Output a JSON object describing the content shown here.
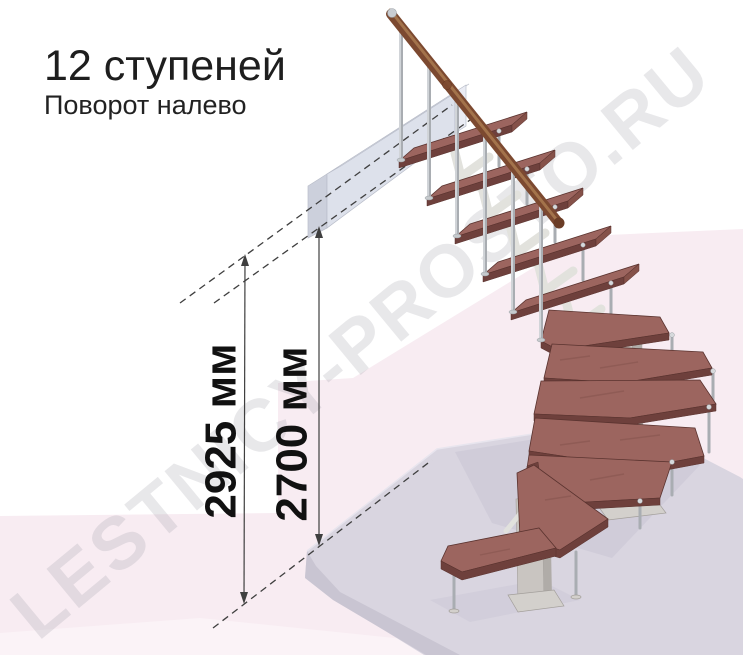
{
  "header": {
    "title": "12 ступеней",
    "subtitle": "Поворот налево"
  },
  "dimensions": {
    "left": {
      "label": "2925 мм",
      "value": 2925,
      "unit": "мм"
    },
    "right": {
      "label": "2700 мм",
      "value": 2700,
      "unit": "мм"
    }
  },
  "watermark": {
    "text": "LESTNICY-PROSTO.RU"
  },
  "staircase": {
    "steps_total": 12,
    "turn_direction": "налево"
  },
  "colors": {
    "tread_top": "#9c655f",
    "tread_edge": "#6e403c",
    "tread_front": "#855149",
    "tread_line": "#5a332f",
    "rail": "#7c4930",
    "rail_hi": "#aa7a50",
    "metal": "#a9adb2",
    "metal_light": "#e6e9ec",
    "spine": "#e2e2dd",
    "post": "#c9c5c1",
    "post_shade": "#b0aca8",
    "post_line": "#a39f9b",
    "plate": "#d3d0cc",
    "beam_front": "#dde1eb",
    "beam_top": "#eaecf4",
    "beam_end": "#ccd0dc",
    "beam_line": "#b9bdc9",
    "floor_top": "#d9d5e0",
    "floor_front": "#c9c5d2",
    "floor_shadow": "#cdc9d7",
    "pink": "#f8ecf2",
    "pink_light": "#fbf3f7",
    "dim": "#3f3f3f",
    "watermark": "#8f8f9a"
  }
}
